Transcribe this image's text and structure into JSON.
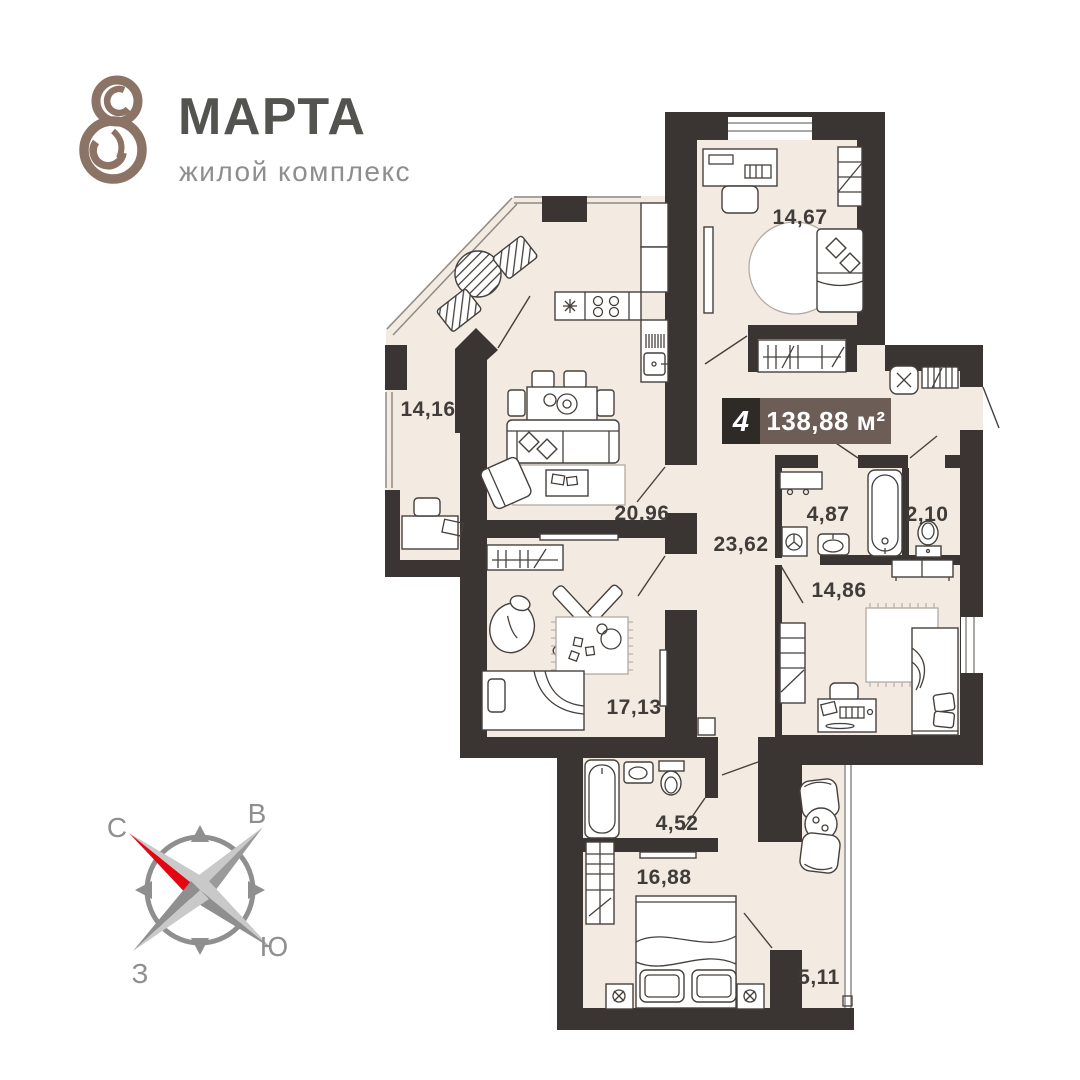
{
  "logo": {
    "title": "МАРТА",
    "subtitle": "жилой комплекс"
  },
  "badge": {
    "rooms": "4",
    "area": "138,88 м²"
  },
  "rooms": {
    "bedroom_top": "14,67",
    "loggia_left": "14,16",
    "kitchen_living": "20,96",
    "hallway": "23,62",
    "bathroom": "4,87",
    "wc": "2,10",
    "bedroom_right": "14,86",
    "kids_room": "17,13",
    "bathroom_small": "4,52",
    "bedroom_bottom": "16,88",
    "loggia_right": "5,11"
  },
  "compass": {
    "north": "С",
    "east": "В",
    "south": "Ю",
    "west": "З"
  },
  "colors": {
    "wall": "#3a3532",
    "floor": "#f3eae1",
    "badge_dark": "#2e2a26",
    "badge_brown": "#6c5d57",
    "logo_brown": "#8b7365",
    "compass_red": "#e30613"
  }
}
